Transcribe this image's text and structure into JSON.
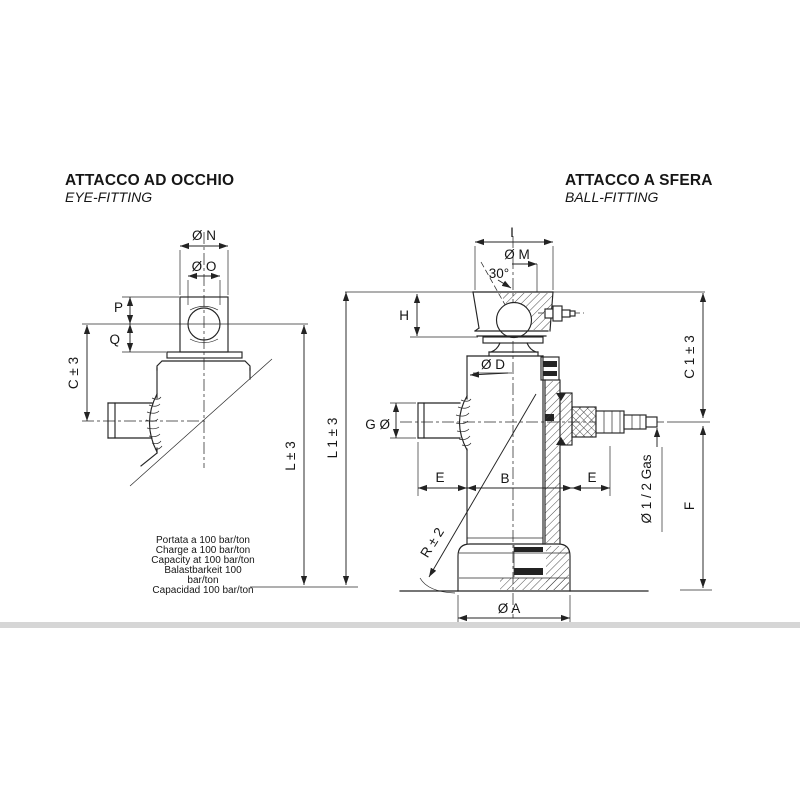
{
  "colors": {
    "line": "#242424",
    "text": "#161616",
    "divider": "#d6d6d6",
    "background": "#ffffff"
  },
  "left_view": {
    "title": "ATTACCO AD OCCHIO",
    "subtitle": "EYE-FITTING",
    "dims": {
      "n": "Ø N",
      "o": "Ø O",
      "p": "P",
      "q": "Q",
      "c": "C ± 3",
      "l": "L ± 3"
    },
    "note_lines": [
      "Portata a 100 bar/ton",
      "Charge a 100 bar/ton",
      "Capacity at 100 bar/ton",
      "Balastbarkeit 100",
      "bar/ton",
      "Capacidad 100 bar/ton"
    ]
  },
  "right_view": {
    "title": "ATTACCO A SFERA",
    "subtitle": "BALL-FITTING",
    "dims": {
      "i": "I",
      "m": "Ø M",
      "angle": "30°",
      "h": "H",
      "d": "Ø D",
      "g": "G Ø",
      "e_left": "E",
      "b": "B",
      "e_right": "E",
      "c1": "C 1 ± 3",
      "gas": "Ø 1 / 2 Gas",
      "f": "F",
      "a": "Ø A",
      "r": "R ± 2",
      "l1": "L 1 ± 3"
    }
  }
}
